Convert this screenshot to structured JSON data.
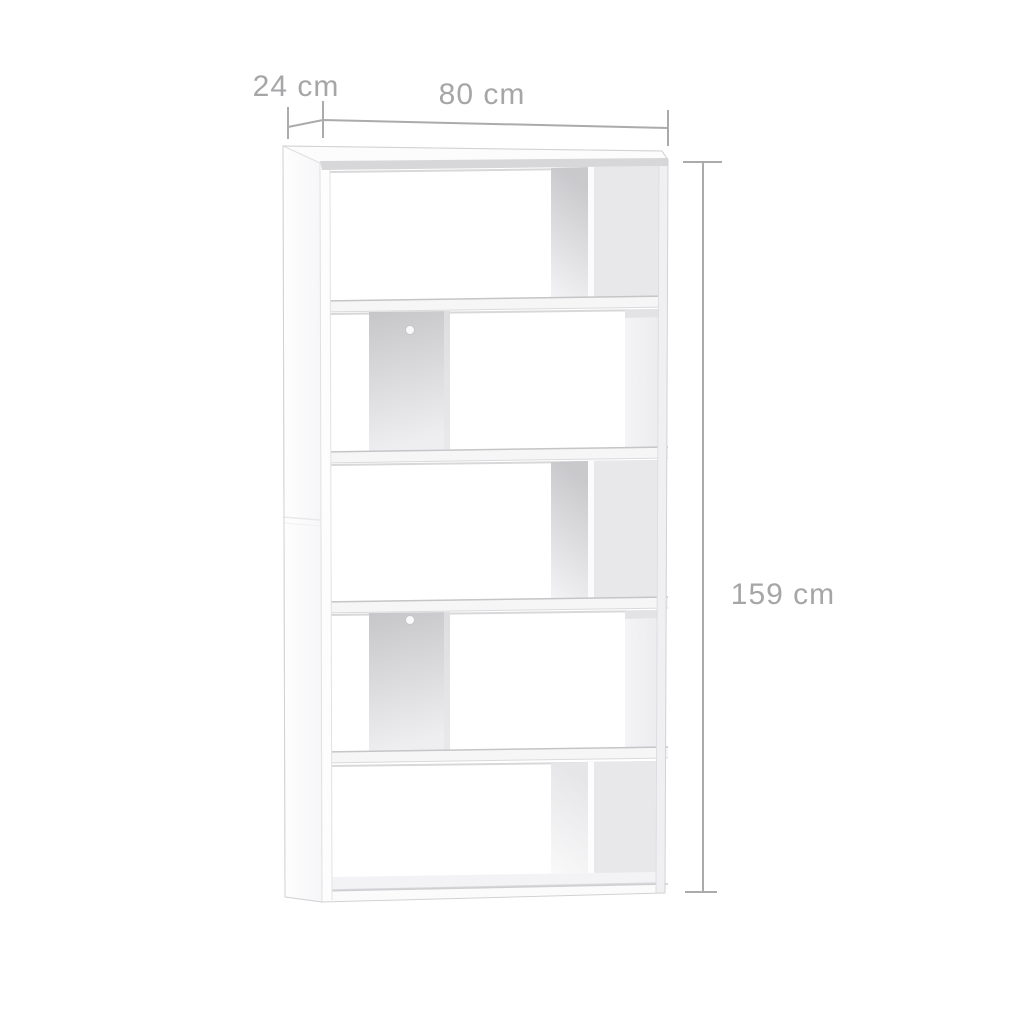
{
  "diagram": {
    "kind": "product-dimension-diagram",
    "subject": "white 5-tier staggered bookcase room divider",
    "tier_count": 5,
    "tier_panel_sides": [
      "right",
      "left",
      "right",
      "left",
      "right"
    ],
    "dimensions": {
      "depth": {
        "label": "24 cm",
        "value": 24,
        "unit": "cm",
        "position": "top-left"
      },
      "width": {
        "label": "80 cm",
        "value": 80,
        "unit": "cm",
        "position": "top"
      },
      "height": {
        "label": "159 cm",
        "value": 159,
        "unit": "cm",
        "position": "right"
      }
    },
    "colors": {
      "background": "#ffffff",
      "furniture_white": "#fcfcfd",
      "back_panel_gray": "#e8e8ea",
      "divider_shade_gray": "#c9c9cc",
      "shelf_edge_gray": "#d2d2d5",
      "dimension_line": "#ababad",
      "dimension_text": "#a6a6a8"
    }
  }
}
